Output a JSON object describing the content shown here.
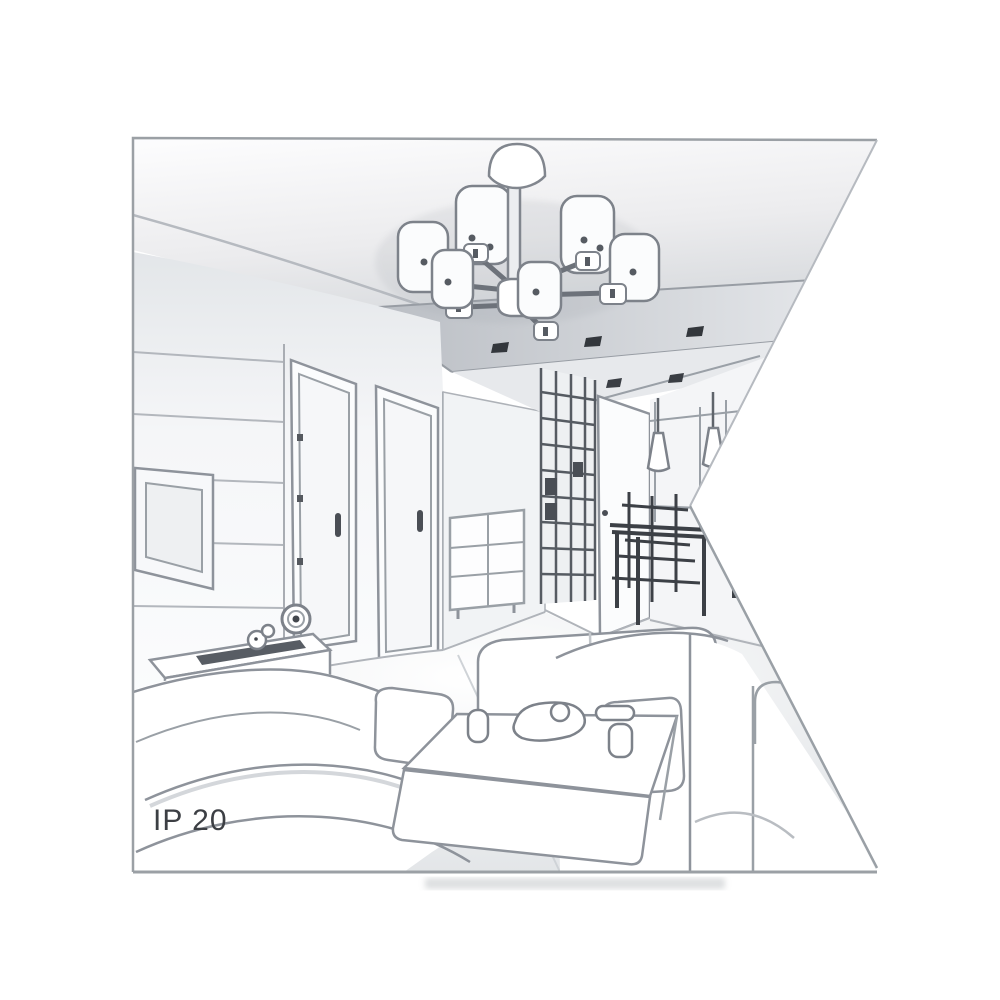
{
  "figure": {
    "ip_rating_label": "IP 20",
    "description": "Gray-line perspective sketch of a living room: six-shade chandelier on the ceiling, recessed spotlights, paneled TV wall with TV, two interior doors, sideboard with clock, sofas, daybed, coffee table with dishes, and a dining nook with cone pendant lamps; right edge of the picture is cut by a white wedge notch",
    "colors": {
      "background": "#ffffff",
      "main_line": "#8e939b",
      "dark_line": "#4a4e55",
      "ceiling_shade": "#cfd3d7",
      "soffit_shade": "#b9bdc3",
      "floor_shade": "#dfe2e5",
      "label_text": "#3c3f44",
      "frame_border": "#9ba0a5"
    },
    "elements": [
      "chandelier",
      "ceiling-spotlights",
      "tv-wall-panels",
      "tv",
      "door-left",
      "door-right",
      "hallway-wardrobe",
      "kitchen-door",
      "drawer-cabinet",
      "dining-table-and-chairs",
      "pendant-cone-lamps",
      "tv-sideboard",
      "clock",
      "figurine",
      "left-sofa",
      "daybed",
      "coffee-table",
      "tableware",
      "right-sofa"
    ]
  }
}
